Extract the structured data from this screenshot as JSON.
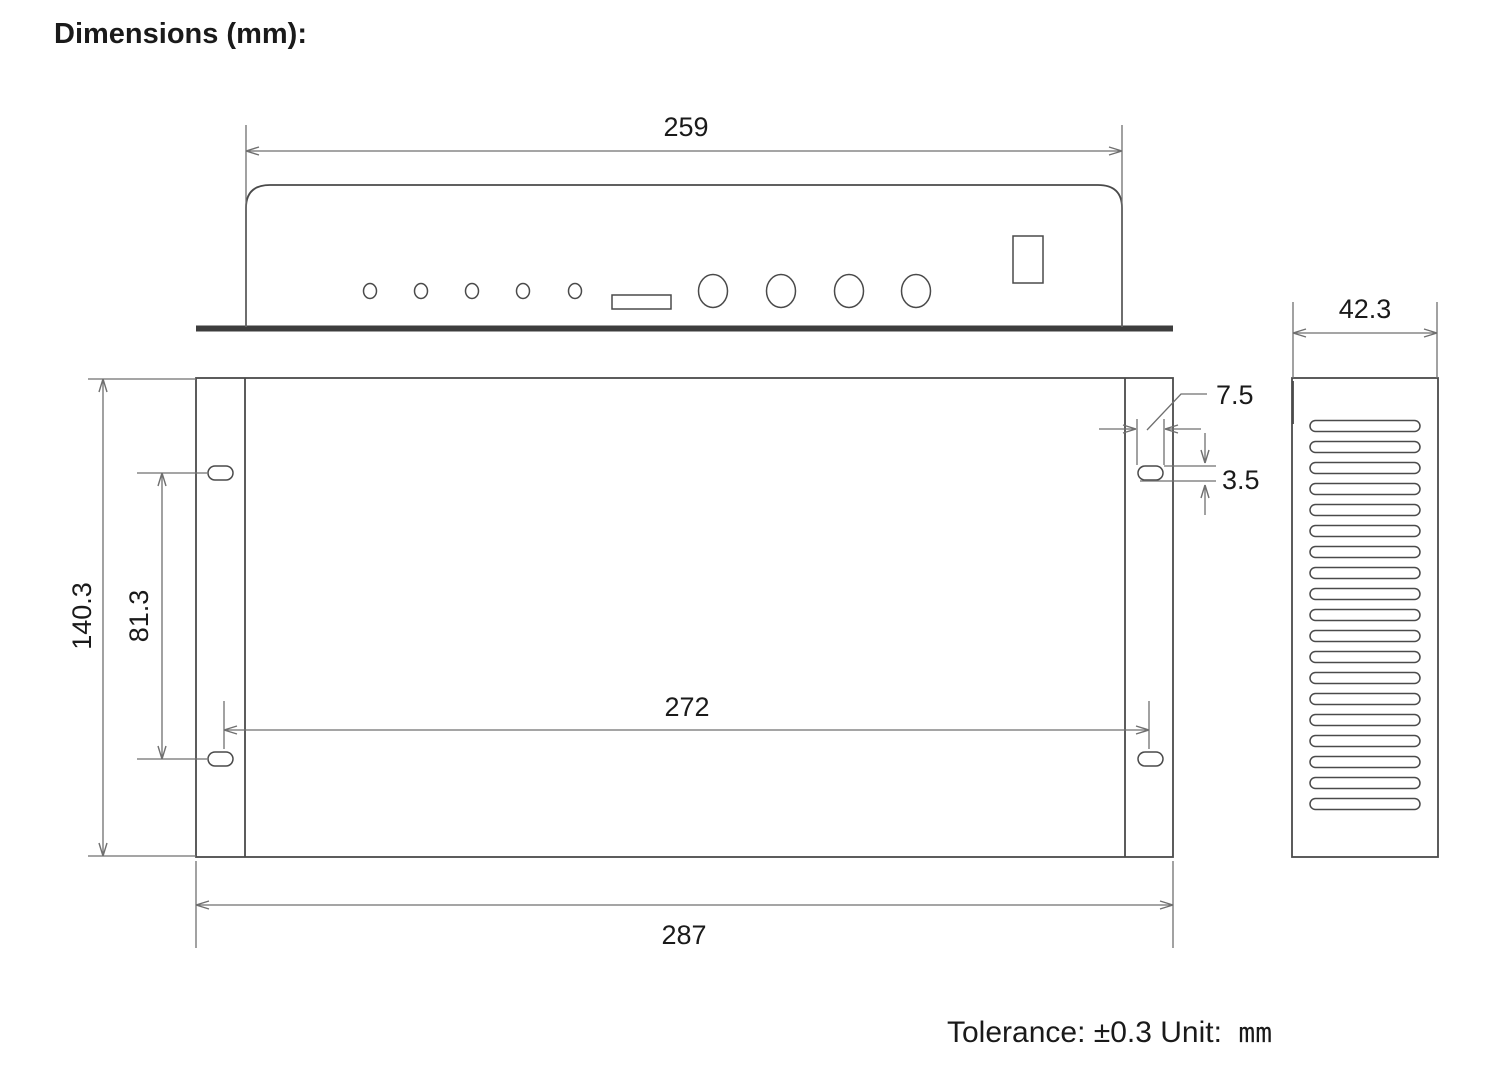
{
  "title": "Dimensions (mm):",
  "footer": {
    "tolerance": "Tolerance: ±0.3 Unit:",
    "unit": "mm"
  },
  "dimensions": {
    "front_width": "259",
    "depth": "42.3",
    "overall_height": "140.3",
    "hole_pitch_vertical": "81.3",
    "hole_pitch_horizontal": "272",
    "overall_width": "287",
    "mount_slot_width": "7.5",
    "mount_slot_height": "3.5"
  },
  "front_panel": {
    "led_hole_count": 5,
    "connector_hole_count": 4
  },
  "side_view": {
    "vent_slot_count": 19
  },
  "colors": {
    "outline": "#4a4a4a",
    "dim_line": "#6f6f6f",
    "baseline": "#3d3d3d",
    "text": "#1a1a1a"
  }
}
